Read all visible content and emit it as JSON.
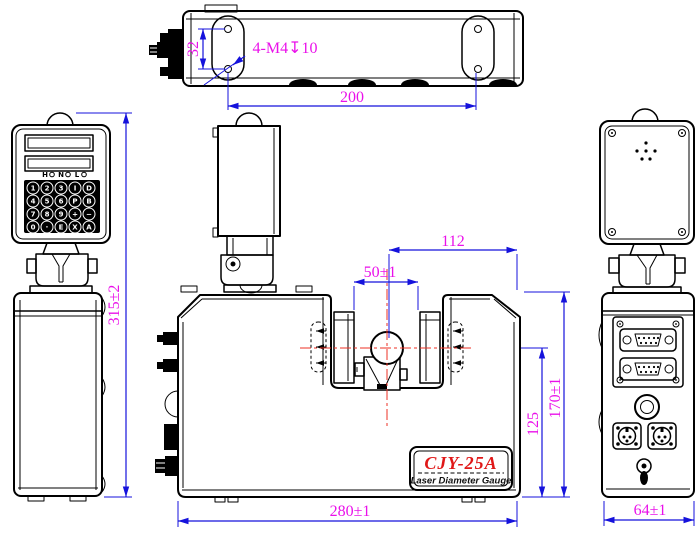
{
  "drawing": {
    "product": {
      "model": "CJY-25A",
      "name": "Laser Diameter Gauge"
    },
    "dimensions": {
      "hole_spacing": "32",
      "thread_callout": "4-M4↧10",
      "hole_pitch": "200",
      "overall_height": "315±2",
      "slot_width": "50±1",
      "axis_to_edge": "112",
      "axis_height": "125",
      "body_height": "170±1",
      "body_width": "280±1",
      "side_width": "64±1"
    },
    "keypad": {
      "indicators": [
        "H",
        "N",
        "L"
      ],
      "keys": [
        "1",
        "2",
        "3",
        "I",
        "D",
        "4",
        "5",
        "6",
        "P",
        "B",
        "7",
        "8",
        "9",
        "+",
        "−",
        "0",
        "·",
        "E",
        "X",
        "A"
      ]
    },
    "colors": {
      "outline": "#000000",
      "dimension_line": "#1512dc",
      "dimension_text": "#ea10ea",
      "centerline": "#ee3226",
      "model_text": "#e01818"
    }
  }
}
